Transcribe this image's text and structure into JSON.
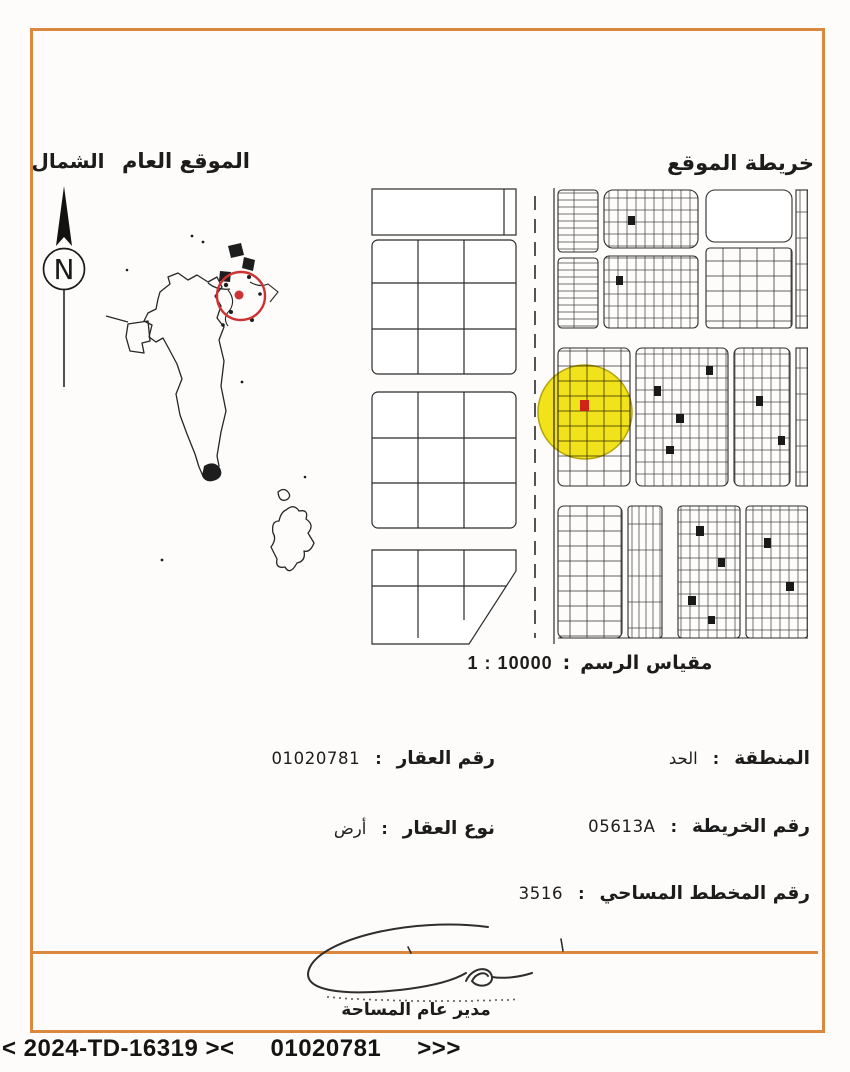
{
  "header": {
    "north_label": "الشمال",
    "general_location_title": "الموقع العام",
    "location_map_title": "خريطة الموقع",
    "compass_letter": "N"
  },
  "map": {
    "scale": {
      "label": "مقياس الرسم",
      "separator": ":",
      "value": "1 : 10000"
    }
  },
  "details": {
    "property_number": {
      "label": "رقم العقار",
      "separator": ":",
      "value": "01020781"
    },
    "property_type": {
      "label": "نوع العقار",
      "separator": ":",
      "value": "أرض"
    },
    "area": {
      "label": "المنطقة",
      "separator": ":",
      "value": "الحد"
    },
    "map_number": {
      "label": "رقم الخريطة",
      "separator": ":",
      "value": "05613A"
    },
    "survey_plan_number": {
      "label": "رقم المخطط المساحي",
      "separator": ":",
      "value": "3516"
    }
  },
  "signature": {
    "title": "مدير عام المساحة"
  },
  "footer": {
    "reference_code": "< 2024-TD-16319 ><",
    "property_number": "01020781",
    "arrows": ">>>"
  },
  "colors": {
    "frame": "#d9883d",
    "highlight": "#f3e51b",
    "marker": "#cf2318",
    "circle_red": "#cc3333"
  }
}
